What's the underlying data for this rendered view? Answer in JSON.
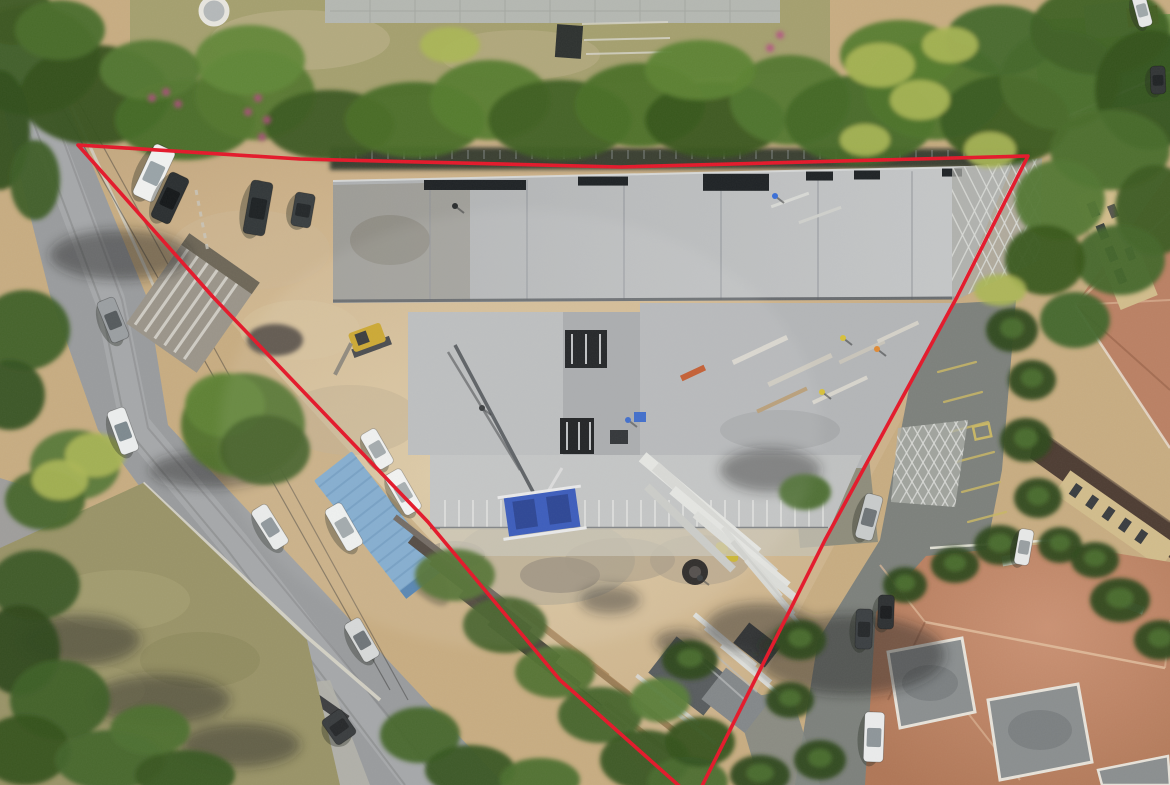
{
  "meta": {
    "type": "aerial-drone-photo",
    "subject": "construction site with red property boundary overlay",
    "width": 1170,
    "height": 785
  },
  "boundary": {
    "points": "78,145 300,159 620,167 1028,156 957,297 825,540 695,800 560,680 428,522 213,297",
    "color": "#e4182a",
    "stroke_width": 3.6
  },
  "palette": {
    "dirt": "#c8ad82",
    "dirt_light": "#dcc9a4",
    "dirt_shadow": "#a6906a",
    "road": "#9a9c9e",
    "road_light": "#b2b4b5",
    "asphalt_dark": "#7d817c",
    "grass_field": "#9a9468",
    "lawn": "#a5a06f",
    "lawn_dry": "#bdb08a",
    "pavement": "#b5b8b2",
    "slab": "#b7b9ba",
    "slab_light": "#c6c8c9",
    "slab_mid": "#a8abae",
    "seam": "#8f9298",
    "formwork": "#8e897e",
    "dark_band": "#3a3f33",
    "tree_dark": "#2f4a1d",
    "tree_mid": "#47682a",
    "tree_light": "#6d9338",
    "palm": "#abb755",
    "flower": "#b84a86",
    "terracotta": "#bb8164",
    "terracotta_light": "#e0bb9b",
    "terracotta_dark": "#8e5b42",
    "flat_roof": "#8b8f90",
    "facade": "#d2bd8c",
    "roof_brown": "#4e3d33",
    "container_blue": "#7ea9cd",
    "machine_blue": "#2f52b8",
    "stripe_yellow": "#c9b765",
    "excavator_yellow": "#c9a327",
    "white_paint": "#eceeec",
    "shadow": "#23281f",
    "wall_light": "#d8d5c8",
    "window_dark": "#3a3d40"
  },
  "scene": {
    "cars": [
      [
        154,
        173,
        115,
        56,
        23,
        "#f1f2f1",
        "#9aa4a8"
      ],
      [
        170,
        198,
        115,
        50,
        21,
        "#2b2f31",
        "#15181a"
      ],
      [
        258,
        208,
        100,
        54,
        22,
        "#33383a",
        "#1e2224"
      ],
      [
        303,
        210,
        100,
        34,
        20,
        "#3a3f41",
        "#24282a"
      ],
      [
        113,
        320,
        68,
        44,
        19,
        "#9b9fa2",
        "#565b5e"
      ],
      [
        123,
        431,
        70,
        46,
        19,
        "#eceeee",
        "#7e8a90"
      ],
      [
        270,
        527,
        58,
        46,
        18,
        "#e9ebea",
        "#8a9297"
      ],
      [
        362,
        640,
        60,
        44,
        18,
        "#d7d9d9",
        "#70767a"
      ],
      [
        377,
        449,
        60,
        40,
        18,
        "#eff0ef",
        "#9fa6a9"
      ],
      [
        403,
        492,
        60,
        46,
        19,
        "#f1f2f1",
        "#a3abad"
      ],
      [
        344,
        527,
        60,
        48,
        19,
        "#eef0ef",
        "#9da5a8"
      ],
      [
        869,
        517,
        105,
        46,
        18,
        "#c9cccc",
        "#6f7578"
      ],
      [
        1024,
        547,
        100,
        36,
        15,
        "#e8e9e8",
        "#999fa2"
      ],
      [
        874,
        737,
        92,
        50,
        20,
        "#ebecec",
        "#8e969a"
      ],
      [
        864,
        629,
        92,
        40,
        17,
        "#3c4043",
        "#26292b"
      ],
      [
        886,
        612,
        92,
        34,
        16,
        "#2e3133",
        "#1b1d1f"
      ],
      [
        339,
        727,
        55,
        30,
        24,
        "#3a3d3f",
        "#27292b"
      ],
      [
        1158,
        80,
        88,
        28,
        15,
        "#323536",
        "#202325"
      ],
      [
        1142,
        10,
        75,
        34,
        14,
        "#e8e9e9",
        "#a0a8ab"
      ]
    ],
    "workers": [
      [
        455,
        206,
        "#2a2d2e"
      ],
      [
        482,
        408,
        "#303335"
      ],
      [
        775,
        196,
        "#3a6fd8"
      ],
      [
        843,
        338,
        "#d8c13a"
      ],
      [
        877,
        349,
        "#e08a34"
      ],
      [
        822,
        392,
        "#d8c13a"
      ],
      [
        700,
        578,
        "#2e3133"
      ],
      [
        628,
        420,
        "#3565c8"
      ]
    ],
    "trees": [
      [
        30,
        60,
        70,
        55,
        "#3d5c26"
      ],
      [
        95,
        95,
        75,
        50,
        "#35511f"
      ],
      [
        185,
        120,
        70,
        40,
        "#476b28"
      ],
      [
        255,
        95,
        60,
        45,
        "#54772e"
      ],
      [
        330,
        125,
        65,
        35,
        "#3c5a22"
      ],
      [
        415,
        120,
        70,
        38,
        "#4a6e28"
      ],
      [
        490,
        100,
        60,
        40,
        "#567c2e"
      ],
      [
        560,
        120,
        72,
        40,
        "#3f6023"
      ],
      [
        640,
        105,
        65,
        42,
        "#4b7029"
      ],
      [
        715,
        120,
        70,
        38,
        "#38571f"
      ],
      [
        790,
        100,
        60,
        45,
        "#527730"
      ],
      [
        860,
        120,
        75,
        45,
        "#436827"
      ],
      [
        935,
        90,
        70,
        50,
        "#4f742c"
      ],
      [
        1005,
        120,
        65,
        45,
        "#3a5a20"
      ],
      [
        1060,
        80,
        60,
        50,
        "#496d2a"
      ],
      [
        250,
        60,
        55,
        35,
        "#62883a"
      ],
      [
        700,
        70,
        55,
        30,
        "#5d8334"
      ],
      [
        900,
        55,
        60,
        35,
        "#567c2e"
      ],
      [
        1000,
        40,
        55,
        35,
        "#44682a"
      ],
      [
        150,
        70,
        50,
        30,
        "#557932"
      ],
      [
        15,
        15,
        40,
        30,
        "#3c5a24"
      ],
      [
        60,
        30,
        45,
        30,
        "#4a6e2c"
      ],
      [
        0,
        130,
        30,
        60,
        "#33501d"
      ],
      [
        35,
        180,
        25,
        40,
        "#3e5e26"
      ],
      [
        25,
        330,
        45,
        40,
        "#3f6026"
      ],
      [
        10,
        395,
        35,
        35,
        "#355321"
      ],
      [
        1100,
        30,
        70,
        45,
        "#3f6125"
      ],
      [
        1150,
        90,
        55,
        60,
        "#34521e"
      ],
      [
        1110,
        150,
        60,
        40,
        "#496d2b"
      ],
      [
        1155,
        210,
        40,
        45,
        "#3c5c23"
      ],
      [
        1120,
        260,
        45,
        35,
        "#44672a"
      ],
      [
        1060,
        200,
        45,
        40,
        "#527731"
      ],
      [
        1045,
        260,
        40,
        35,
        "#3a591f"
      ],
      [
        1075,
        320,
        35,
        28,
        "#42652a"
      ],
      [
        243,
        425,
        62,
        52,
        "#4f712c"
      ],
      [
        225,
        405,
        40,
        32,
        "#5f8436"
      ],
      [
        265,
        450,
        45,
        35,
        "#3e5c22"
      ],
      [
        75,
        465,
        45,
        35,
        "#58793a"
      ],
      [
        45,
        500,
        40,
        30,
        "#47662c"
      ],
      [
        455,
        575,
        40,
        26,
        "#4d6e2a"
      ],
      [
        505,
        625,
        42,
        28,
        "#3e5c22"
      ],
      [
        555,
        672,
        40,
        26,
        "#527334"
      ],
      [
        600,
        715,
        42,
        28,
        "#44642a"
      ],
      [
        645,
        760,
        45,
        30,
        "#395722"
      ],
      [
        688,
        782,
        40,
        25,
        "#4c6d2e"
      ],
      [
        700,
        742,
        35,
        25,
        "#355320"
      ],
      [
        660,
        700,
        30,
        22,
        "#5a7d38"
      ],
      [
        805,
        492,
        26,
        18,
        "#4c6d2e"
      ],
      [
        420,
        735,
        40,
        28,
        "#46672c"
      ],
      [
        470,
        770,
        45,
        25,
        "#395722"
      ],
      [
        540,
        780,
        40,
        22,
        "#4e7030"
      ],
      [
        35,
        585,
        45,
        35,
        "#3b5a26"
      ],
      [
        20,
        650,
        40,
        45,
        "#2f4a1d"
      ],
      [
        60,
        700,
        50,
        40,
        "#3f6028"
      ],
      [
        25,
        750,
        45,
        35,
        "#35521f"
      ],
      [
        110,
        760,
        55,
        30,
        "#44652c"
      ],
      [
        185,
        775,
        50,
        25,
        "#3a5823"
      ],
      [
        150,
        730,
        40,
        25,
        "#4e7030"
      ]
    ],
    "campus_palms": [
      [
        1012,
        330,
        26,
        22
      ],
      [
        1032,
        380,
        24,
        20
      ],
      [
        1026,
        440,
        26,
        22
      ],
      [
        1038,
        498,
        24,
        20
      ],
      [
        1000,
        545,
        26,
        20
      ],
      [
        955,
        565,
        24,
        18
      ],
      [
        905,
        585,
        22,
        18
      ],
      [
        1060,
        545,
        22,
        18
      ],
      [
        1120,
        600,
        30,
        22
      ],
      [
        1160,
        640,
        26,
        20
      ],
      [
        800,
        640,
        26,
        20
      ],
      [
        790,
        700,
        24,
        18
      ],
      [
        820,
        760,
        26,
        20
      ],
      [
        760,
        775,
        30,
        20
      ],
      [
        690,
        660,
        28,
        20
      ],
      [
        1095,
        560,
        24,
        18
      ]
    ],
    "palms": [
      [
        880,
        65,
        35,
        22
      ],
      [
        920,
        100,
        30,
        20
      ],
      [
        950,
        45,
        28,
        18
      ],
      [
        450,
        45,
        30,
        18
      ],
      [
        990,
        150,
        26,
        18
      ],
      [
        865,
        140,
        25,
        16
      ],
      [
        95,
        455,
        30,
        22
      ],
      [
        60,
        480,
        28,
        20
      ],
      [
        1000,
        290,
        26,
        16
      ]
    ],
    "flowers": [
      [
        152,
        98
      ],
      [
        166,
        92
      ],
      [
        178,
        104
      ],
      [
        248,
        112
      ],
      [
        258,
        98
      ],
      [
        267,
        120
      ],
      [
        262,
        137
      ],
      [
        780,
        35
      ],
      [
        770,
        48
      ]
    ],
    "ground_shadows": [
      [
        120,
        255,
        70,
        25
      ],
      [
        210,
        470,
        60,
        18
      ],
      [
        80,
        640,
        60,
        25
      ],
      [
        160,
        700,
        70,
        25
      ],
      [
        240,
        745,
        60,
        22
      ],
      [
        850,
        655,
        95,
        40
      ],
      [
        760,
        628,
        55,
        25
      ],
      [
        770,
        470,
        50,
        22
      ],
      [
        610,
        600,
        30,
        14
      ],
      [
        680,
        642,
        25,
        12
      ]
    ],
    "stripes": [
      [
        938,
        372,
        976,
        362
      ],
      [
        944,
        402,
        982,
        392
      ],
      [
        950,
        432,
        988,
        422
      ],
      [
        956,
        462,
        994,
        452
      ],
      [
        962,
        492,
        1000,
        482
      ],
      [
        968,
        522,
        1006,
        512
      ],
      [
        888,
        648,
        926,
        640
      ],
      [
        884,
        680,
        922,
        672
      ],
      [
        880,
        712,
        918,
        704
      ],
      [
        902,
        742,
        894,
        783
      ],
      [
        930,
        750,
        920,
        785
      ],
      [
        958,
        756,
        948,
        785
      ]
    ],
    "rebar": [
      {
        "x": 470,
        "y": 585,
        "l": 150,
        "w": 10,
        "r": 38,
        "c": "#4a4038"
      },
      {
        "x": 495,
        "y": 610,
        "l": 160,
        "w": 9,
        "r": 38,
        "c": "#433c34"
      },
      {
        "x": 520,
        "y": 640,
        "l": 150,
        "w": 8,
        "r": 38,
        "c": "#4a4038"
      },
      {
        "x": 545,
        "y": 665,
        "l": 140,
        "w": 8,
        "r": 38,
        "c": "#3e3830"
      },
      {
        "x": 450,
        "y": 560,
        "l": 140,
        "w": 6,
        "r": 38,
        "c": "#6b625a"
      }
    ],
    "lumber": [
      {
        "x": 560,
        "y": 640,
        "l": 120,
        "w": 7,
        "r": 38,
        "c": "#b08e62"
      },
      {
        "x": 585,
        "y": 660,
        "l": 110,
        "w": 6,
        "r": 38,
        "c": "#a8875d"
      },
      {
        "x": 610,
        "y": 680,
        "l": 100,
        "w": 6,
        "r": 38,
        "c": "#b08e62"
      },
      {
        "x": 635,
        "y": 700,
        "l": 110,
        "w": 6,
        "r": 38,
        "c": "#9c7e57"
      },
      {
        "x": 590,
        "y": 700,
        "l": 90,
        "w": 5,
        "r": 38,
        "c": "#b49267"
      },
      {
        "x": 640,
        "y": 730,
        "l": 90,
        "w": 5,
        "r": 38,
        "c": "#a8875d"
      },
      {
        "x": 668,
        "y": 700,
        "l": 80,
        "w": 4,
        "r": 38,
        "c": "#d9d6cf"
      },
      {
        "x": 688,
        "y": 722,
        "l": 70,
        "w": 4,
        "r": 38,
        "c": "#cfcbc2"
      },
      {
        "x": 700,
        "y": 505,
        "l": 150,
        "w": 12,
        "r": 40,
        "c": "#e3e4e0"
      },
      {
        "x": 715,
        "y": 520,
        "l": 160,
        "w": 11,
        "r": 42,
        "c": "#d6d7d3"
      },
      {
        "x": 730,
        "y": 538,
        "l": 150,
        "w": 10,
        "r": 40,
        "c": "#e3e4e0"
      },
      {
        "x": 690,
        "y": 528,
        "l": 120,
        "w": 8,
        "r": 44,
        "c": "#c8c9c5"
      },
      {
        "x": 745,
        "y": 556,
        "l": 130,
        "w": 8,
        "r": 40,
        "c": "#dcddd9"
      },
      {
        "x": 725,
        "y": 640,
        "l": 80,
        "w": 5,
        "r": 40,
        "c": "#dedfdb"
      },
      {
        "x": 738,
        "y": 655,
        "l": 85,
        "w": 5,
        "r": 40,
        "c": "#d3d4d0"
      },
      {
        "x": 750,
        "y": 670,
        "l": 75,
        "w": 4,
        "r": 40,
        "c": "#dedfdb"
      }
    ],
    "pipes": [
      {
        "x": 752,
        "y": 562,
        "l": 90,
        "w": 5,
        "r": 50,
        "c": "#d9dad6"
      },
      {
        "x": 763,
        "y": 578,
        "l": 95,
        "w": 5,
        "r": 50,
        "c": "#cfd0cc"
      },
      {
        "x": 774,
        "y": 594,
        "l": 88,
        "w": 4,
        "r": 50,
        "c": "#d9dad6"
      }
    ],
    "deck_lumber": [
      {
        "x": 760,
        "y": 350,
        "l": 60,
        "w": 5,
        "r": -25,
        "c": "#d8d5cd"
      },
      {
        "x": 800,
        "y": 370,
        "l": 70,
        "w": 5,
        "r": -25,
        "c": "#cdc9bf"
      },
      {
        "x": 840,
        "y": 390,
        "l": 60,
        "w": 4,
        "r": -25,
        "c": "#d8d5cd"
      },
      {
        "x": 782,
        "y": 400,
        "l": 55,
        "w": 4,
        "r": -25,
        "c": "#b59a73"
      },
      {
        "x": 862,
        "y": 352,
        "l": 50,
        "w": 4,
        "r": -25,
        "c": "#c9c5bb"
      },
      {
        "x": 898,
        "y": 332,
        "l": 45,
        "w": 4,
        "r": -25,
        "c": "#d5d2c9"
      },
      {
        "x": 693,
        "y": 373,
        "l": 26,
        "w": 6,
        "r": -25,
        "c": "#c05528"
      },
      {
        "x": 790,
        "y": 200,
        "l": 40,
        "w": 3,
        "r": -20,
        "c": "#d8d9d5"
      },
      {
        "x": 820,
        "y": 215,
        "l": 45,
        "w": 3,
        "r": -20,
        "c": "#cfd0cc"
      }
    ],
    "deck_seams": [
      430,
      527,
      624,
      721,
      818,
      912
    ],
    "deck_slots": [
      {
        "x": 424,
        "w": 102,
        "h": 10
      },
      {
        "x": 578,
        "w": 50,
        "h": 9
      },
      {
        "x": 703,
        "w": 66,
        "h": 17
      },
      {
        "x": 806,
        "w": 27,
        "h": 9
      },
      {
        "x": 854,
        "w": 26,
        "h": 9
      },
      {
        "x": 942,
        "w": 20,
        "h": 8
      }
    ],
    "dirt_patches": [
      [
        545,
        560,
        90,
        45,
        "#b2a78f",
        0.7
      ],
      [
        600,
        480,
        60,
        30,
        "#b7ab92",
        0.6
      ],
      [
        350,
        420,
        70,
        35,
        "#bfae8e",
        0.5
      ],
      [
        250,
        250,
        80,
        40,
        "#cdb896",
        0.5
      ],
      [
        700,
        560,
        50,
        25,
        "#ab9d85",
        0.6
      ],
      [
        560,
        575,
        40,
        18,
        "#8b8173",
        0.6
      ],
      [
        455,
        555,
        30,
        14,
        "#93897a",
        0.6
      ],
      [
        300,
        330,
        60,
        30,
        "#d5c19c",
        0.5
      ],
      [
        620,
        560,
        55,
        22,
        "#9d927e",
        0.5
      ]
    ]
  }
}
